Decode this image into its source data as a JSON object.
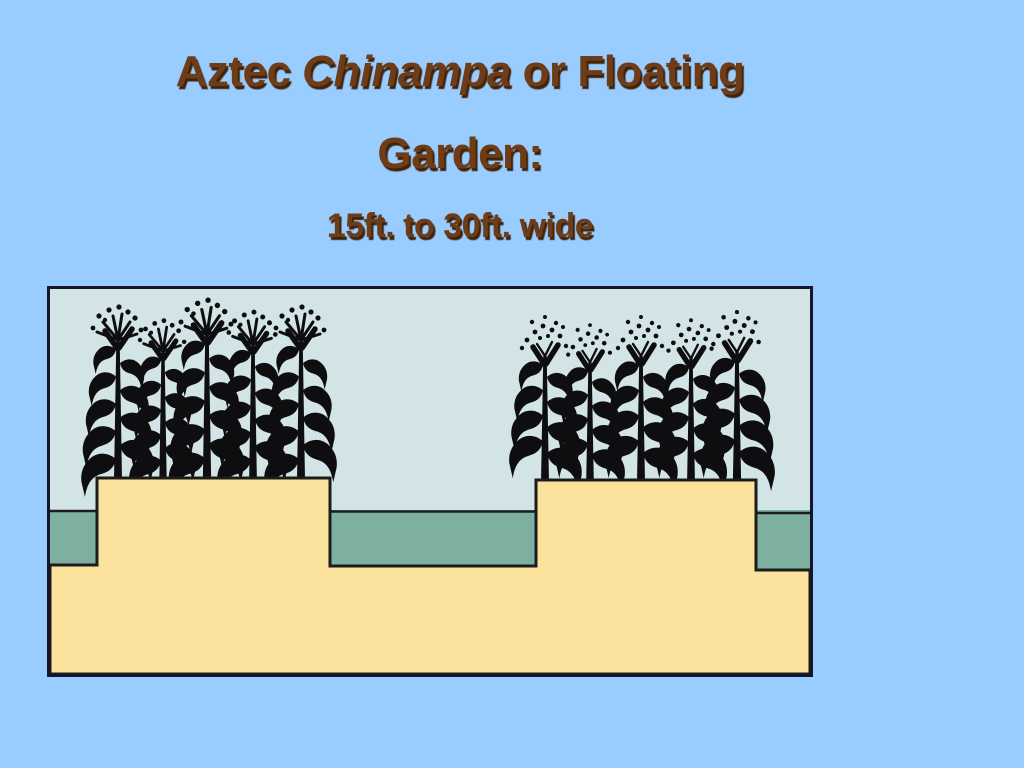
{
  "slide": {
    "title": {
      "part1": "Aztec ",
      "part2_italic": "Chinampa",
      "part3": " or Floating",
      "line2": "Garden:",
      "subtitle": "15ft. to 30ft. wide"
    },
    "illustration": {
      "alt": "Cross-section illustration of two Aztec chinampa raised garden beds planted with maize, separated by green water-filled canals above tan earth",
      "left_bed_plants": 5,
      "right_bed_plants": 5
    },
    "colors": {
      "background": "#99ccff",
      "title_text": "#6e3c16",
      "title_shadow": "#40230b",
      "frame_border": "#15152c",
      "sky": "#d3e4e7",
      "water": "#7eb0a1",
      "earth": "#fce39d",
      "outline": "#1c1c1c",
      "plant": "#0e0e10"
    }
  }
}
